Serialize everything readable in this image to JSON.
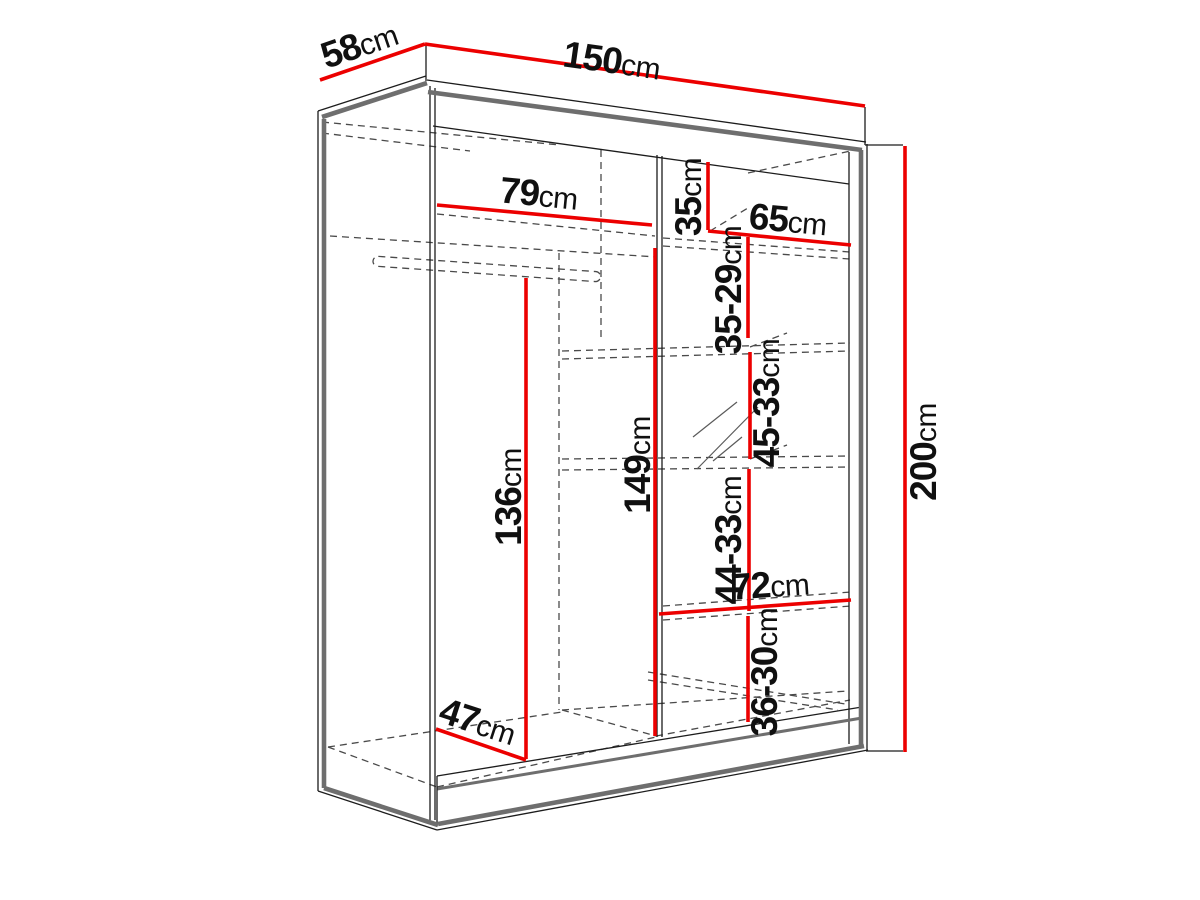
{
  "diagram": {
    "type": "furniture-dimension-drawing",
    "subject": "sliding-door wardrobe, perspective line drawing with red dimension lines"
  },
  "colors": {
    "dimension_line": "#ec0000",
    "outline": "#6e6e6e",
    "thin_line": "#1c1c1c",
    "dashed_line": "#4a4a4a",
    "background": "#ffffff"
  },
  "dims": {
    "width150": {
      "value": "150",
      "unit": "cm"
    },
    "depth58": {
      "value": "58",
      "unit": "cm"
    },
    "height200": {
      "value": "200",
      "unit": "cm"
    },
    "shelf79": {
      "value": "79",
      "unit": "cm"
    },
    "shelf65": {
      "value": "65",
      "unit": "cm"
    },
    "gap35": {
      "value": "35",
      "unit": "cm"
    },
    "gap35_29": {
      "value": "35-29",
      "unit": "cm"
    },
    "gap45_33": {
      "value": "45-33",
      "unit": "cm"
    },
    "gap44_33": {
      "value": "44-33",
      "unit": "cm"
    },
    "gap36_30": {
      "value": "36-30",
      "unit": "cm"
    },
    "hang136": {
      "value": "136",
      "unit": "cm"
    },
    "interior149": {
      "value": "149",
      "unit": "cm"
    },
    "shelf72": {
      "value": "72",
      "unit": "cm"
    },
    "depth47": {
      "value": "47",
      "unit": "cm"
    }
  }
}
